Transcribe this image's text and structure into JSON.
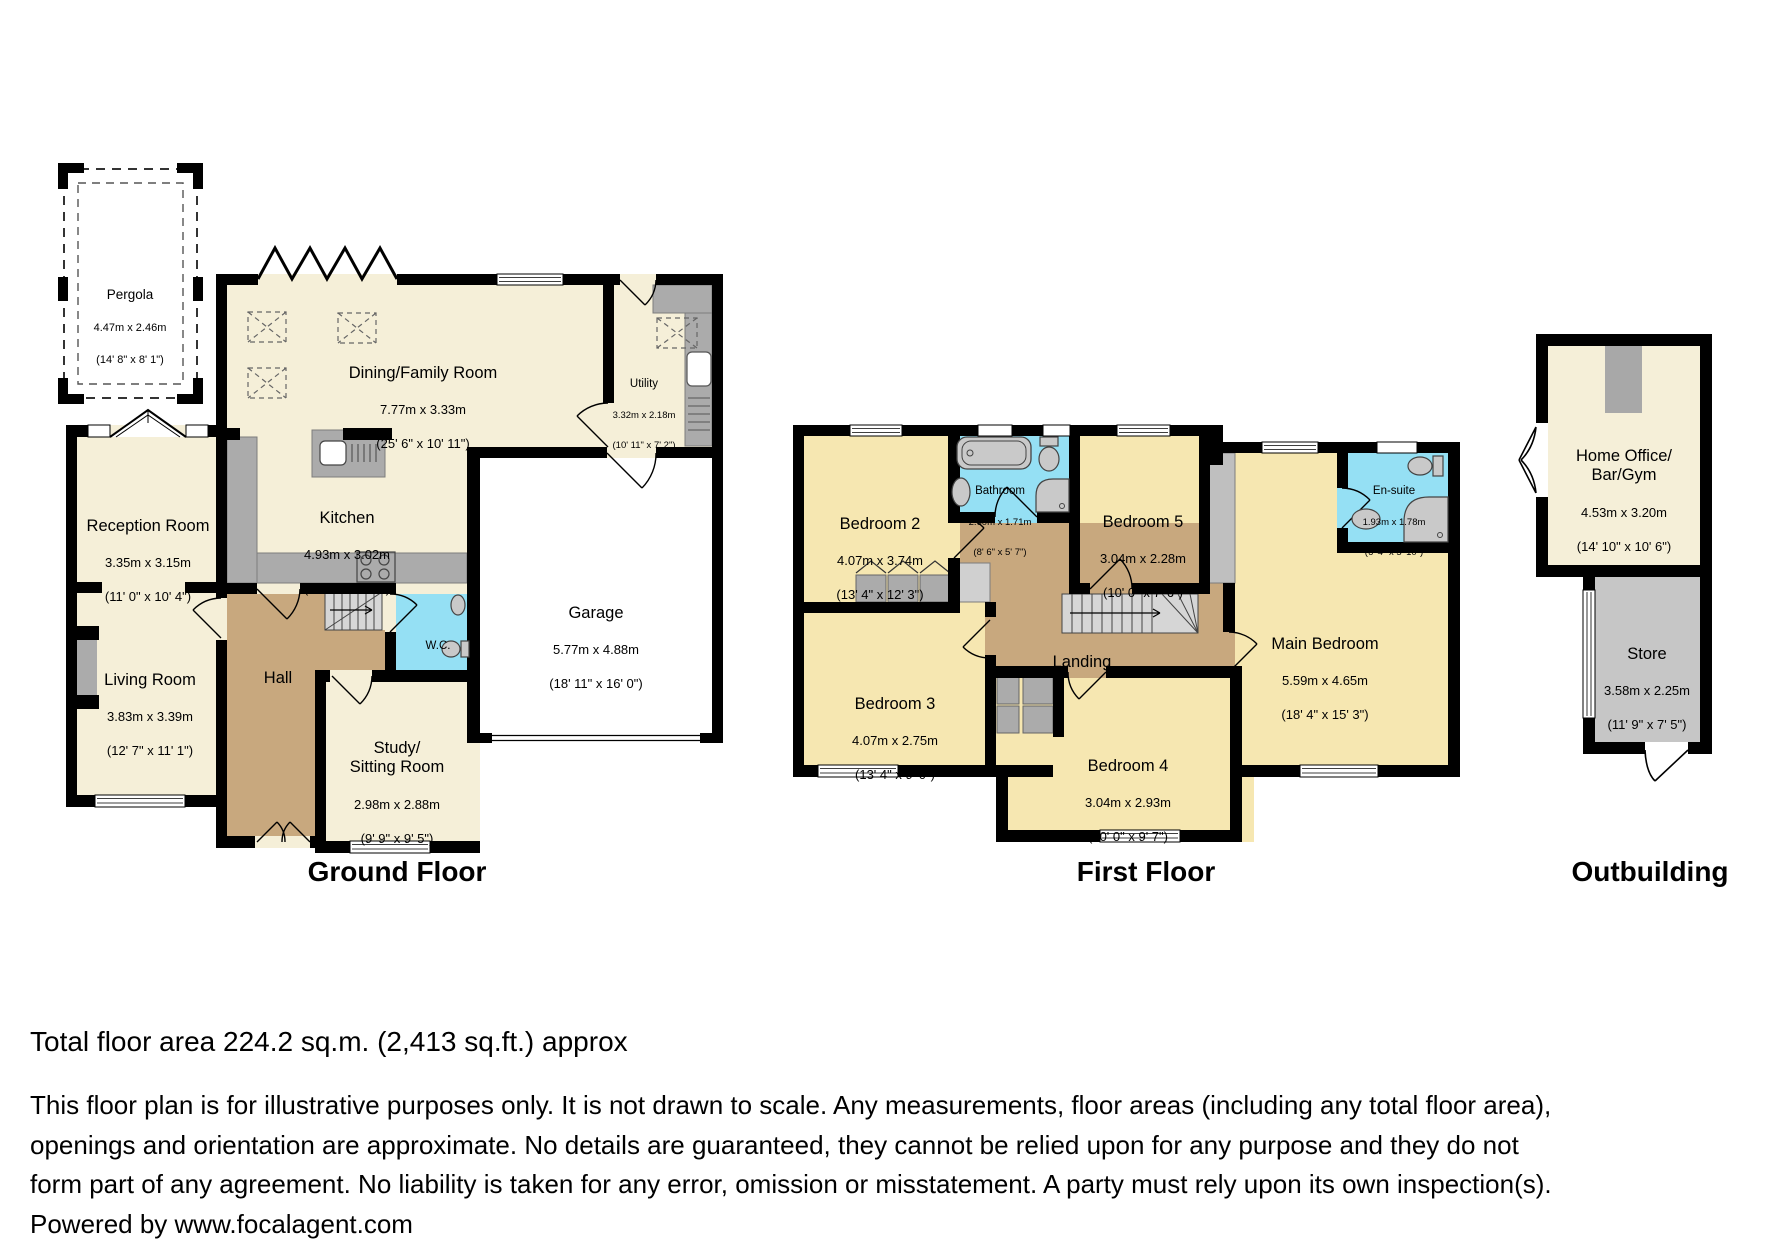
{
  "floors": {
    "ground": {
      "title": "Ground Floor",
      "rooms": {
        "pergola": {
          "name": "Pergola",
          "metric": "4.47m x 2.46m",
          "imperial": "(14' 8\" x 8' 1\")"
        },
        "dining": {
          "name": "Dining/Family Room",
          "metric": "7.77m x 3.33m",
          "imperial": "(25' 6\" x 10' 11\")"
        },
        "utility": {
          "name": "Utility",
          "metric": "3.32m x 2.18m",
          "imperial": "(10' 11\" x 7' 2\")"
        },
        "reception": {
          "name": "Reception Room",
          "metric": "3.35m x 3.15m",
          "imperial": "(11' 0\" x 10' 4\")"
        },
        "kitchen": {
          "name": "Kitchen",
          "metric": "4.93m x 3.02m",
          "imperial": "(16' 2\" x 9' 11\")"
        },
        "living": {
          "name": "Living Room",
          "metric": "3.83m x 3.39m",
          "imperial": "(12' 7\" x 11' 1\")"
        },
        "hall": {
          "name": "Hall"
        },
        "wc": {
          "name": "W.C."
        },
        "study": {
          "name": "Study/\nSitting Room",
          "metric": "2.98m x 2.88m",
          "imperial": "(9' 9\" x 9' 5\")"
        },
        "garage": {
          "name": "Garage",
          "metric": "5.77m x 4.88m",
          "imperial": "(18' 11\" x 16' 0\")"
        }
      }
    },
    "first": {
      "title": "First Floor",
      "rooms": {
        "bedroom2": {
          "name": "Bedroom 2",
          "metric": "4.07m x 3.74m",
          "imperial": "(13' 4\" x 12' 3\")"
        },
        "bathroom": {
          "name": "Bathroom",
          "metric": "2.60m x 1.71m",
          "imperial": "(8' 6\" x 5' 7\")"
        },
        "bedroom5": {
          "name": "Bedroom 5",
          "metric": "3.04m x 2.28m",
          "imperial": "(10' 0\" x 7' 6\")"
        },
        "ensuite": {
          "name": "En-suite",
          "metric": "1.93m x 1.78m",
          "imperial": "(6' 4\" x 5' 10\")"
        },
        "main": {
          "name": "Main Bedroom",
          "metric": "5.59m x 4.65m",
          "imperial": "(18' 4\" x 15' 3\")"
        },
        "bedroom3": {
          "name": "Bedroom 3",
          "metric": "4.07m x 2.75m",
          "imperial": "(13' 4\" x 9' 0\")"
        },
        "landing": {
          "name": "Landing"
        },
        "bedroom4": {
          "name": "Bedroom 4",
          "metric": "3.04m x 2.93m",
          "imperial": "(10' 0\" x 9' 7\")"
        }
      }
    },
    "outbuilding": {
      "title": "Outbuilding",
      "rooms": {
        "office": {
          "name": "Home Office/\nBar/Gym",
          "metric": "4.53m x 3.20m",
          "imperial": "(14' 10\" x 10' 6\")"
        },
        "store": {
          "name": "Store",
          "metric": "3.58m x 2.25m",
          "imperial": "(11' 9\" x 7' 5\")"
        }
      }
    }
  },
  "footer": {
    "total_area": "Total floor area 224.2 sq.m. (2,413 sq.ft.) approx",
    "disclaimer": "This floor plan is for illustrative purposes only. It is not drawn to scale. Any measurements, floor areas (including any total floor area), openings and orientation are approximate. No details are guaranteed, they cannot be relied upon for any purpose and they do not form part of any agreement. No liability is taken for any error, omission or misstatement. A party must rely upon its own inspection(s). Powered by www.focalagent.com"
  },
  "colors": {
    "cream": "#F5EFD8",
    "bedroom_yellow": "#F6E7B1",
    "hall_tan": "#C8A87E",
    "wet_blue": "#95E0F4",
    "counter_gray": "#ABABAB",
    "store_gray": "#C6C6C6",
    "wall_black": "#000000"
  }
}
